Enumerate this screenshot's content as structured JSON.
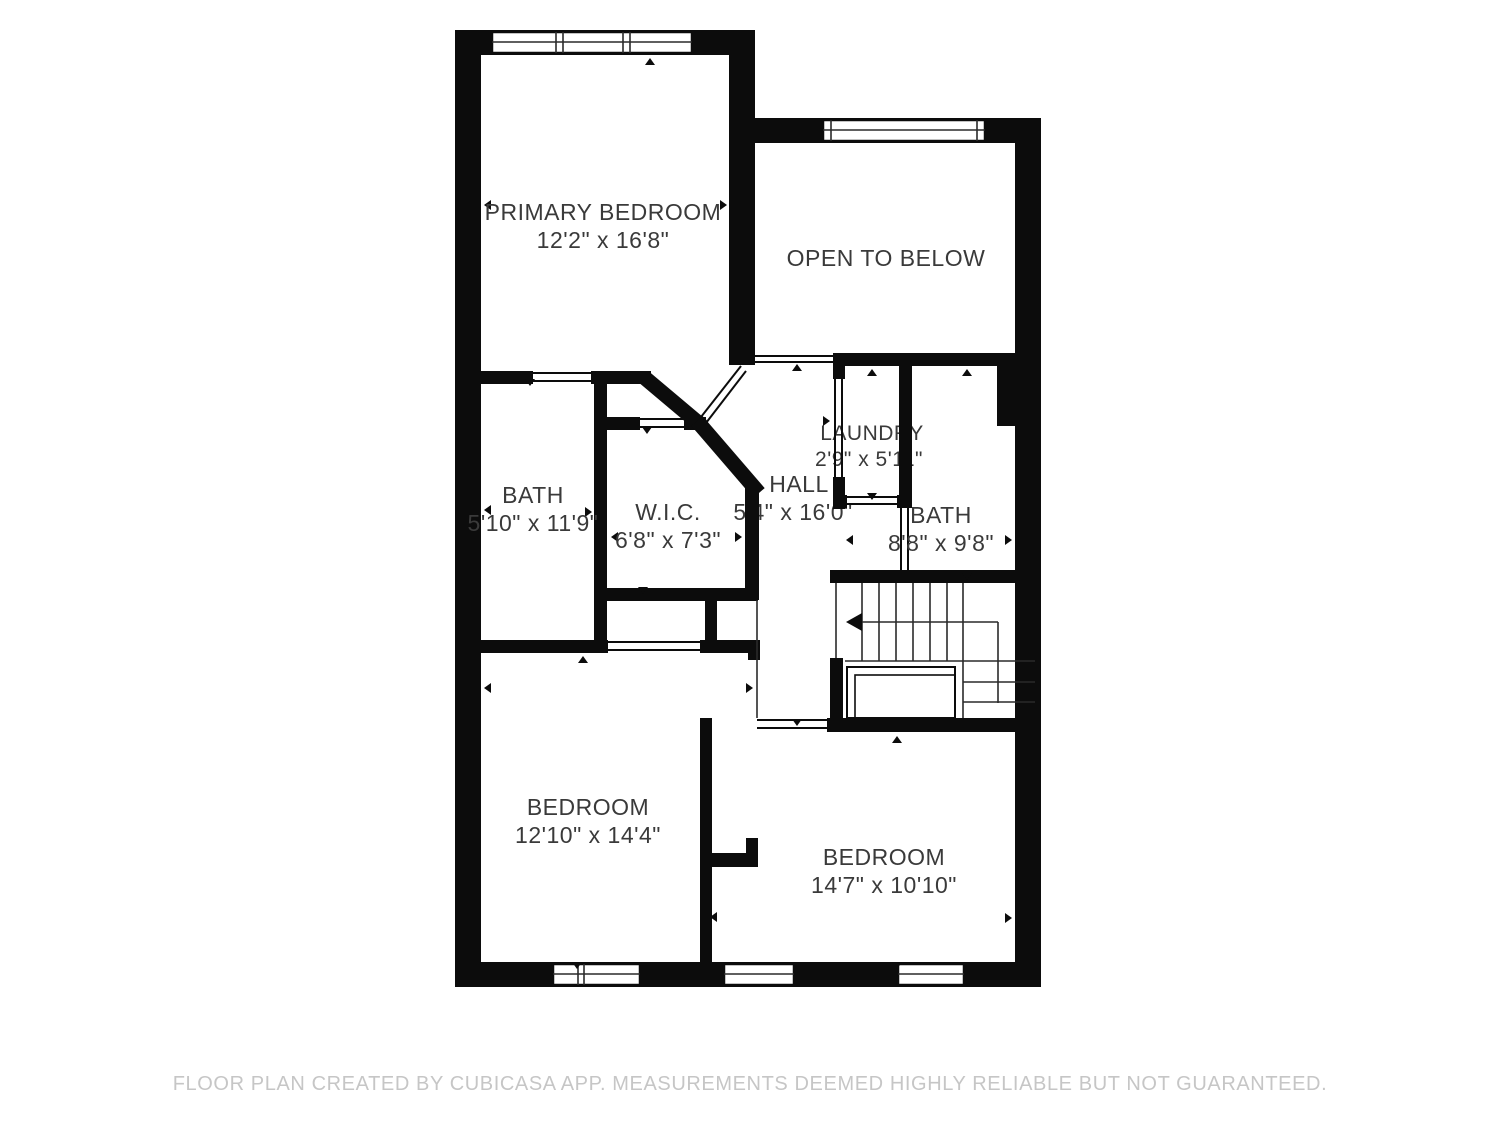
{
  "floorplan": {
    "rooms": [
      {
        "name": "PRIMARY BEDROOM",
        "dims": "12'2\" x 16'8\""
      },
      {
        "name": "OPEN TO BELOW",
        "dims": ""
      },
      {
        "name": "BATH",
        "dims": "5'10\" x 11'9\""
      },
      {
        "name": "W.I.C.",
        "dims": "6'8\" x 7'3\""
      },
      {
        "name": "HALL",
        "dims": "5'4\" x 16'0\""
      },
      {
        "name": "LAUNDRY",
        "dims": "2'9\" x 5'11\""
      },
      {
        "name": "BATH",
        "dims": "8'8\" x 9'8\""
      },
      {
        "name": "BEDROOM",
        "dims": "12'10\" x 14'4\""
      },
      {
        "name": "BEDROOM",
        "dims": "14'7\" x 10'10\""
      }
    ],
    "footer": "FLOOR PLAN CREATED BY CUBICASA APP. MEASUREMENTS DEEMED HIGHLY RELIABLE BUT NOT GUARANTEED.",
    "colors": {
      "wall": "#0c0c0c",
      "label_text": "#3a3a3a",
      "footer_text": "#c6c6c6",
      "background": "#ffffff"
    }
  }
}
